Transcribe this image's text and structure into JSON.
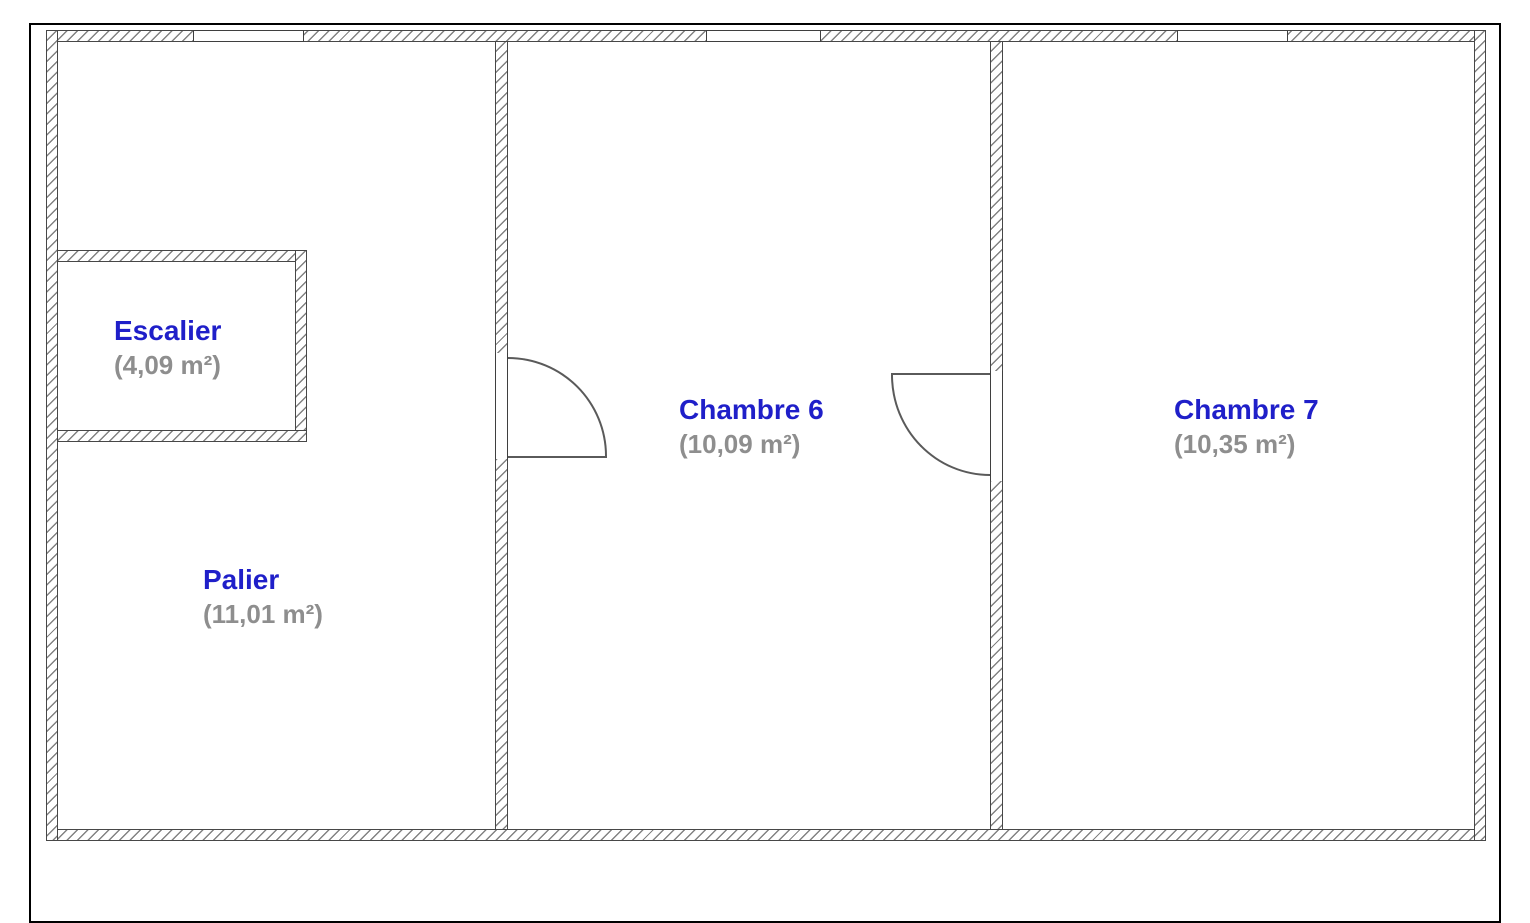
{
  "rooms": [
    {
      "id": "escalier",
      "name": "Escalier",
      "area": "(4,09 m²)"
    },
    {
      "id": "palier",
      "name": "Palier",
      "area": "(11,01 m²)"
    },
    {
      "id": "chambre-6",
      "name": "Chambre 6",
      "area": "(10,09 m²)"
    },
    {
      "id": "chambre-7",
      "name": "Chambre 7",
      "area": "(10,35 m²)"
    }
  ],
  "colors": {
    "room_name": "#1f1fc9",
    "room_area": "#8e8e8e",
    "wall_edge": "#474747",
    "wall_hatch": "#828282",
    "page_border": "#000000"
  }
}
